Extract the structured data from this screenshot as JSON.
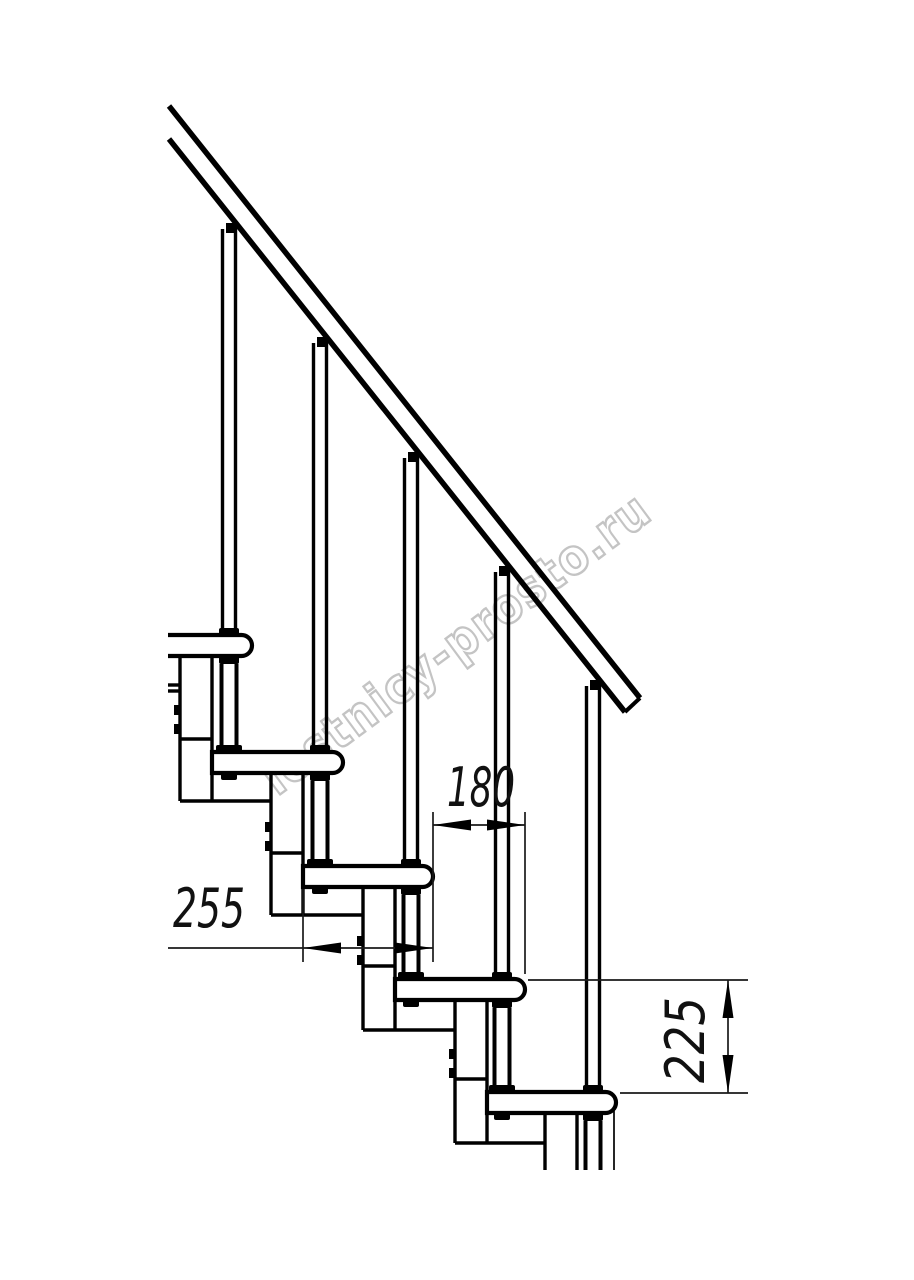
{
  "page": {
    "background": "#ffffff",
    "line_color": "#000000",
    "thin_line_color": "#1a1a1a"
  },
  "watermark": {
    "text": "lestnicy-prosto.ru",
    "outline_color": "#c4c4c4",
    "fill_color": "#ffffff",
    "rotation_deg": -36.5
  },
  "drawing": {
    "type": "staircase-side-view-technical-drawing",
    "visible_treads": 5,
    "visible_balusters": 5,
    "dimensions": [
      {
        "id": "tread_depth",
        "label": "255",
        "orientation": "horizontal"
      },
      {
        "id": "step_run",
        "label": "180",
        "orientation": "horizontal"
      },
      {
        "id": "step_rise",
        "label": "225",
        "orientation": "vertical"
      }
    ]
  }
}
